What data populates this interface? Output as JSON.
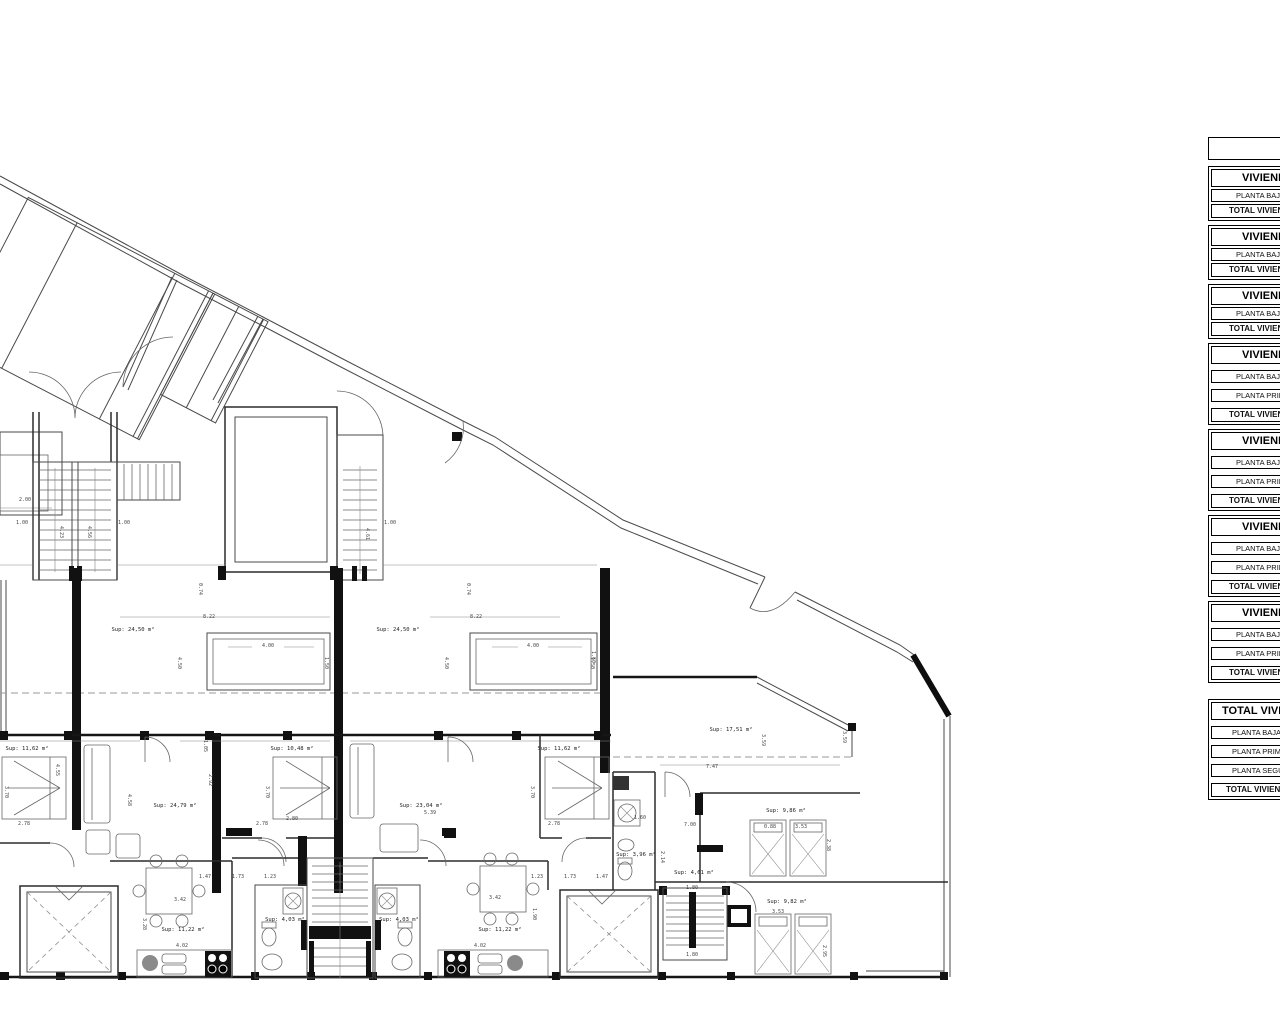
{
  "plan": {
    "rooms": [
      {
        "id": "terrace-a",
        "text": "Sup: 24,50 m²",
        "x": 133,
        "y": 631
      },
      {
        "id": "terrace-b",
        "text": "Sup: 24,50 m²",
        "x": 398,
        "y": 631
      },
      {
        "id": "terrace-c",
        "text": "Sup: 17,51 m²",
        "x": 731,
        "y": 731
      },
      {
        "id": "bedroom-a1",
        "text": "Sup: 11,62 m²",
        "x": 27,
        "y": 750
      },
      {
        "id": "living-a",
        "text": "Sup: 24,79 m²",
        "x": 175,
        "y": 807
      },
      {
        "id": "bedroom-a2",
        "text": "Sup: 10,48 m²",
        "x": 292,
        "y": 750
      },
      {
        "id": "living-b",
        "text": "Sup: 23,04 m²",
        "x": 421,
        "y": 807
      },
      {
        "id": "bedroom-b1",
        "text": "Sup: 11,62 m²",
        "x": 559,
        "y": 750
      },
      {
        "id": "bath-c",
        "text": "Sup: 3,96 m²",
        "x": 636,
        "y": 856
      },
      {
        "id": "hall-c",
        "text": "Sup: 4,61 m²",
        "x": 694,
        "y": 874
      },
      {
        "id": "bedroom-c1",
        "text": "Sup: 9,86 m²",
        "x": 786,
        "y": 812
      },
      {
        "id": "bedroom-c2",
        "text": "Sup: 9,82 m²",
        "x": 787,
        "y": 903
      },
      {
        "id": "kitchen-a",
        "text": "Sup: 11,22 m²",
        "x": 183,
        "y": 931
      },
      {
        "id": "kitchen-b",
        "text": "Sup: 11,22 m²",
        "x": 500,
        "y": 931
      },
      {
        "id": "bath-a",
        "text": "Sup: 4,03 m²",
        "x": 285,
        "y": 921
      },
      {
        "id": "bath-b",
        "text": "Sup: 4,03 m²",
        "x": 399,
        "y": 921
      }
    ],
    "dimensions": [
      {
        "text": "1.00",
        "x": 22,
        "y": 524,
        "rot": 0
      },
      {
        "text": "1.00",
        "x": 124,
        "y": 524,
        "rot": 0
      },
      {
        "text": "1.00",
        "x": 390,
        "y": 524,
        "rot": 0
      },
      {
        "text": "4.23",
        "x": 60,
        "y": 532,
        "rot": 90
      },
      {
        "text": "4.56",
        "x": 88,
        "y": 532,
        "rot": 90
      },
      {
        "text": "4.61",
        "x": 366,
        "y": 534,
        "rot": 90
      },
      {
        "text": "8.22",
        "x": 209,
        "y": 618,
        "rot": 0
      },
      {
        "text": "8.22",
        "x": 476,
        "y": 618,
        "rot": 0
      },
      {
        "text": "0.74",
        "x": 199,
        "y": 589,
        "rot": 90
      },
      {
        "text": "0.74",
        "x": 467,
        "y": 589,
        "rot": 90
      },
      {
        "text": "4.00",
        "x": 268,
        "y": 647,
        "rot": 0
      },
      {
        "text": "4.00",
        "x": 533,
        "y": 647,
        "rot": 0
      },
      {
        "text": "1.50",
        "x": 325,
        "y": 663,
        "rot": 90
      },
      {
        "text": "1.50",
        "x": 591,
        "y": 663,
        "rot": 90
      },
      {
        "text": "4.50",
        "x": 178,
        "y": 663,
        "rot": 90
      },
      {
        "text": "4.50",
        "x": 445,
        "y": 663,
        "rot": 90
      },
      {
        "text": "3.70",
        "x": 5,
        "y": 792,
        "rot": 90
      },
      {
        "text": "3.70",
        "x": 266,
        "y": 792,
        "rot": 90
      },
      {
        "text": "3.70",
        "x": 531,
        "y": 792,
        "rot": 90
      },
      {
        "text": "4.55",
        "x": 56,
        "y": 770,
        "rot": 90
      },
      {
        "text": "4.58",
        "x": 128,
        "y": 800,
        "rot": 90
      },
      {
        "text": "1.05",
        "x": 204,
        "y": 746,
        "rot": 90
      },
      {
        "text": "2.92",
        "x": 209,
        "y": 780,
        "rot": 90
      },
      {
        "text": "2.78",
        "x": 24,
        "y": 825,
        "rot": 0
      },
      {
        "text": "2.78",
        "x": 262,
        "y": 825,
        "rot": 0
      },
      {
        "text": "2.80",
        "x": 292,
        "y": 820,
        "rot": 0
      },
      {
        "text": "2.78",
        "x": 554,
        "y": 825,
        "rot": 0
      },
      {
        "text": "5.39",
        "x": 430,
        "y": 814,
        "rot": 0
      },
      {
        "text": "1.47",
        "x": 205,
        "y": 878,
        "rot": 0
      },
      {
        "text": "1.73",
        "x": 238,
        "y": 878,
        "rot": 0
      },
      {
        "text": "1.23",
        "x": 270,
        "y": 878,
        "rot": 0
      },
      {
        "text": "1.23",
        "x": 537,
        "y": 878,
        "rot": 0
      },
      {
        "text": "1.73",
        "x": 570,
        "y": 878,
        "rot": 0
      },
      {
        "text": "1.47",
        "x": 602,
        "y": 878,
        "rot": 0
      },
      {
        "text": "3.42",
        "x": 180,
        "y": 901,
        "rot": 0
      },
      {
        "text": "3.42",
        "x": 495,
        "y": 899,
        "rot": 0
      },
      {
        "text": "3.28",
        "x": 143,
        "y": 924,
        "rot": 90
      },
      {
        "text": "1.90",
        "x": 533,
        "y": 914,
        "rot": 90
      },
      {
        "text": "4.02",
        "x": 182,
        "y": 947,
        "rot": 0
      },
      {
        "text": "4.02",
        "x": 480,
        "y": 947,
        "rot": 0
      },
      {
        "text": "7.00",
        "x": 690,
        "y": 826,
        "rot": 0
      },
      {
        "text": "7.47",
        "x": 712,
        "y": 768,
        "rot": 0
      },
      {
        "text": "0.88",
        "x": 770,
        "y": 828,
        "rot": 0
      },
      {
        "text": "3.53",
        "x": 801,
        "y": 828,
        "rot": 0
      },
      {
        "text": "2.38",
        "x": 827,
        "y": 845,
        "rot": 90
      },
      {
        "text": "1.60",
        "x": 640,
        "y": 819,
        "rot": 0
      },
      {
        "text": "2.14",
        "x": 661,
        "y": 857,
        "rot": 90
      },
      {
        "text": "1.80",
        "x": 692,
        "y": 889,
        "rot": 0
      },
      {
        "text": "1.80",
        "x": 692,
        "y": 956,
        "rot": 0
      },
      {
        "text": "3.53",
        "x": 778,
        "y": 913,
        "rot": 0
      },
      {
        "text": "2.95",
        "x": 823,
        "y": 951,
        "rot": 90
      },
      {
        "text": "3.59",
        "x": 762,
        "y": 740,
        "rot": 90
      },
      {
        "text": "3.59",
        "x": 843,
        "y": 737,
        "rot": 90
      },
      {
        "text": "1.60",
        "x": 592,
        "y": 657,
        "rot": 90
      },
      {
        "text": "2.00",
        "x": 25,
        "y": 501,
        "rot": 0
      }
    ]
  },
  "tables": {
    "dwellings": [
      {
        "title": "VIVIENDA",
        "rows": [
          {
            "label": "PLANTA BAJA",
            "bold": false
          },
          {
            "label": "TOTAL VIVIENDA",
            "bold": true
          }
        ]
      },
      {
        "title": "VIVIENDA",
        "rows": [
          {
            "label": "PLANTA BAJA",
            "bold": false
          },
          {
            "label": "TOTAL VIVIENDA",
            "bold": true
          }
        ]
      },
      {
        "title": "VIVIENDA",
        "rows": [
          {
            "label": "PLANTA BAJA",
            "bold": false
          },
          {
            "label": "TOTAL VIVIENDA",
            "bold": true
          }
        ]
      },
      {
        "title": "VIVIENDA",
        "rows": [
          {
            "label": "PLANTA BAJA",
            "bold": false
          },
          {
            "label": "PLANTA PRIMERA",
            "bold": false
          },
          {
            "label": "TOTAL VIVIENDA",
            "bold": true
          }
        ]
      },
      {
        "title": "VIVIENDA",
        "rows": [
          {
            "label": "PLANTA BAJA",
            "bold": false
          },
          {
            "label": "PLANTA PRIMERA",
            "bold": false
          },
          {
            "label": "TOTAL VIVIENDA",
            "bold": true
          }
        ]
      },
      {
        "title": "VIVIENDA",
        "rows": [
          {
            "label": "PLANTA BAJA",
            "bold": false
          },
          {
            "label": "PLANTA PRIMERA",
            "bold": false
          },
          {
            "label": "TOTAL VIVIENDA",
            "bold": true
          }
        ]
      },
      {
        "title": "VIVIENDA",
        "rows": [
          {
            "label": "PLANTA BAJA",
            "bold": false
          },
          {
            "label": "PLANTA PRIMERA",
            "bold": false
          },
          {
            "label": "TOTAL VIVIENDA",
            "bold": true
          }
        ]
      }
    ],
    "total": {
      "title": "TOTAL VIVIENDAS",
      "rows": [
        {
          "label": "PLANTA BAJA",
          "bold": false
        },
        {
          "label": "PLANTA PRIMERA",
          "bold": false
        },
        {
          "label": "PLANTA SEGUNDA",
          "bold": false
        },
        {
          "label": "TOTAL VIVIENDAS",
          "bold": true
        }
      ]
    }
  }
}
